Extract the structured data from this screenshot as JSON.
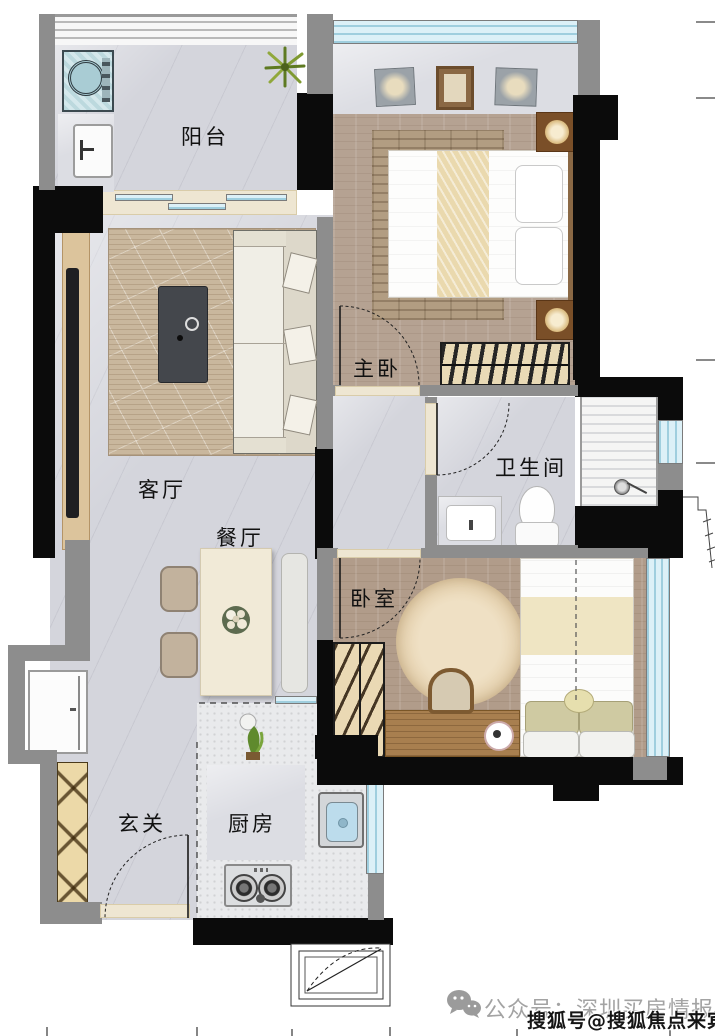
{
  "rooms": {
    "balcony": {
      "label": "阳台"
    },
    "master_bedroom": {
      "label": "主卧"
    },
    "living_room": {
      "label": "客厅"
    },
    "dining_room": {
      "label": "餐厅"
    },
    "bathroom": {
      "label": "卫生间"
    },
    "bedroom": {
      "label": "卧室"
    },
    "entry": {
      "label": "玄关"
    },
    "kitchen": {
      "label": "厨房"
    }
  },
  "watermark": {
    "wechat_icon": "wechat-icon",
    "wechat_text": "公众号：深圳买房情报",
    "sohu_text": "搜狐号@搜狐焦点来宾站"
  },
  "colors": {
    "wall_black": "#0b0b0b",
    "wall_gray": "#8d8d8d",
    "floor_marble": "#d4d5dc",
    "floor_wood": "#b5a292",
    "window_blue": "#cfe9f3",
    "threshold_beige": "#eee6d2",
    "label_text": "#111111",
    "watermark_gray": "#a3a3a3",
    "watermark_black": "#151515"
  }
}
